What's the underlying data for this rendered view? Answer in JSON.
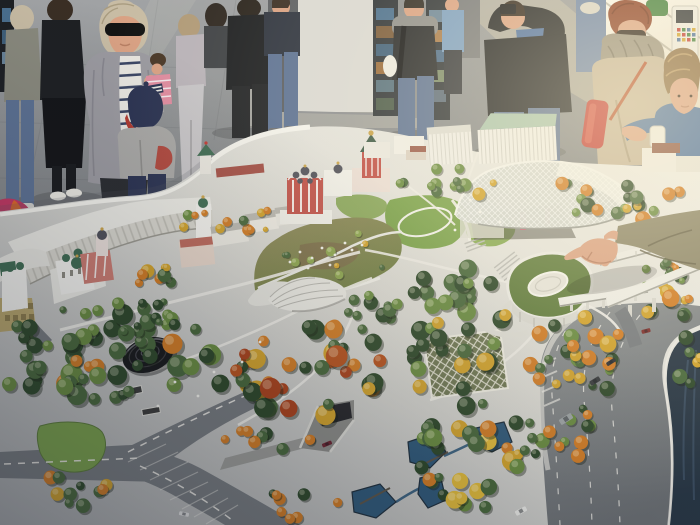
{
  "scene": {
    "type": "photograph",
    "description": "Visitors gathered around a large architectural scale model of a riverside park in autumn colours; a hand points at the model from the right; bright daylight from windows at top right.",
    "no_visible_text": true
  },
  "palette": {
    "floor": "#97999b",
    "floorDark": "#7b7e81",
    "sunFloor": "#cdc6b2",
    "wall": "#dad9d4",
    "wallShade": "#5c5f63",
    "panel": "#2e3338",
    "window": "#f8f5ec",
    "base": "#dcdbd5",
    "baseBright": "#f0efe9",
    "baseShade": "#a9abac",
    "rim": "#f3f2ec",
    "plaza": "#d7d6d0",
    "road": "#75797d",
    "roadDark": "#63676b",
    "lane": "#eceae4",
    "hwy": "#7d8286",
    "river": "#273543",
    "pond": "#2f5878",
    "lawn": "#79a04a",
    "meadowTan": "#93895c",
    "meadowGreen": "#6e7d42",
    "gDark": "#2d4729",
    "gMid": "#47663a",
    "gBright": "#67893f",
    "gLime": "#8ba44e",
    "oDeep": "#b5511d",
    "oBright": "#cf7a24",
    "rust": "#a8421c",
    "yGold": "#cfa02b",
    "yBright": "#deb83a",
    "churchRed": "#c05048",
    "churchPink": "#c97a70",
    "trim": "#f0efeb",
    "domeDark": "#50505a",
    "domeGreen": "#3f6b52",
    "gold": "#c9a24a",
    "roofGreen": "#a9c4ae",
    "roofGrey": "#b9b7b0",
    "tan": "#b5a36a",
    "disc": "#17181a",
    "bridge": "#ebeae4",
    "skin": "#d9a183",
    "skinShade": "#b87f63",
    "hairBlonde": "#c8bca4",
    "hairDark": "#3a2e24",
    "hairLt": "#b09a78",
    "hairRed": "#8a3d24",
    "hairBrown": "#8a6a42",
    "cardigan": "#9b9aa0",
    "navy": "#3a4563",
    "capNavy": "#2b3352",
    "capRed": "#b03a30",
    "hoodie": "#a9a8a6",
    "scarf": "#968e7d",
    "coat": "#c3b399",
    "jeans": "#5d7294",
    "denim": "#6d84a8",
    "blueJacket": "#4a6f9e",
    "blueShirt": "#7a9ec2",
    "black": "#1e2023",
    "darkPants": "#2b2d31",
    "grey": "#8b8d90",
    "olive": "#8a8a7e",
    "lilac": "#b8b2b8",
    "paleGrey": "#c6c4c7",
    "sand": "#d9cdb4",
    "sleeve": "#8a8468",
    "sleeveShade": "#615c45",
    "green": "#3f7d3c",
    "redBag": "#c23832",
    "pink": "#e08ca0",
    "white": "#eceae2"
  },
  "people": [
    {
      "id": "bystander-left-jeans",
      "desc": "partial figure at left edge: olive top, blue jeans, white shoes"
    },
    {
      "id": "woman-black-skirt",
      "desc": "dark top, long black skirt, white sneakers, facing away"
    },
    {
      "id": "woman-sunglasses",
      "desc": "blonde woman, large black sunglasses, grey cardigan over navy-striped top, holding a child's raised hand"
    },
    {
      "id": "toddler-pink",
      "desc": "small child in pink striped top behind the woman"
    },
    {
      "id": "child-navy-cap",
      "desc": "child in navy beanie with red brim and grey hoodie with red patch"
    },
    {
      "id": "girl-grey",
      "desc": "girl in grey top and light trousers walking away"
    },
    {
      "id": "man-black-jacket",
      "desc": "man in black jacket and dark trousers"
    },
    {
      "id": "man-blue-jeans",
      "desc": "man in dark top and blue jeans"
    },
    {
      "id": "man-vest-backpack",
      "desc": "man in grey hoodie, black vest, jeans, backpack strap, white bag"
    },
    {
      "id": "person-blue-shirt",
      "desc": "figure in light blue shirt"
    },
    {
      "id": "man-photographing",
      "desc": "man in black sweater with arms raised holding a phone, blue jeans"
    },
    {
      "id": "woman-scarf",
      "desc": "red-haired woman with sunglasses, voluminous taupe scarf, beige coat, red bag"
    },
    {
      "id": "boy-brown-hair",
      "desc": "boy with brown mop hair in blue jacket holding a white cup, reaching over the model"
    },
    {
      "id": "pointing-hand",
      "desc": "arm in olive sleeve entering from the right, index finger pointing at the model"
    }
  ],
  "model_features": [
    "curved-white-classical-building",
    "tan-block-building",
    "white-church-green-domes",
    "pink-bell-tower",
    "kremlin-tower-and-wall",
    "red-church-with-domes",
    "red-tent-roof-church",
    "street-building-row",
    "white-slab-building-green-roof",
    "black-spiral-pavilion",
    "glass-bark-canopy",
    "small-shell-canopy",
    "diagrid-glass-pavilion",
    "green-roof-amphitheatre",
    "floating-v-bridge",
    "viaduct-with-piers",
    "road-junction-with-grass-island",
    "road-tunnel-portal",
    "underpass-slots",
    "embankment-highway",
    "river-corner",
    "ponds-and-streams",
    "meadow-with-winding-paths",
    "lawns-with-path-loops",
    "tree-allees"
  ],
  "trees": {
    "clusters": [
      {
        "x": 150,
        "y": 360,
        "rx": 105,
        "ry": 52,
        "n": 44,
        "rmin": 5,
        "rmax": 11,
        "seed": 11,
        "colors": [
          "gMid",
          "gDark",
          "gBright",
          "gMid",
          "oBright",
          "gDark"
        ]
      },
      {
        "x": 28,
        "y": 345,
        "rx": 30,
        "ry": 55,
        "n": 12,
        "rmin": 5,
        "rmax": 10,
        "seed": 22,
        "colors": [
          "gMid",
          "gDark",
          "gBright"
        ]
      },
      {
        "x": 315,
        "y": 372,
        "rx": 80,
        "ry": 48,
        "n": 40,
        "rmin": 5,
        "rmax": 11,
        "seed": 33,
        "colors": [
          "oDeep",
          "oBright",
          "rust",
          "gMid",
          "yGold",
          "oBright",
          "gDark"
        ]
      },
      {
        "x": 452,
        "y": 330,
        "rx": 55,
        "ry": 70,
        "n": 36,
        "rmin": 5,
        "rmax": 10,
        "seed": 44,
        "colors": [
          "gDark",
          "gMid",
          "gDark",
          "gBright",
          "yGold"
        ]
      },
      {
        "x": 585,
        "y": 352,
        "rx": 62,
        "ry": 40,
        "n": 26,
        "rmin": 4,
        "rmax": 9,
        "seed": 55,
        "colors": [
          "gMid",
          "gDark",
          "gBright",
          "oBright",
          "yGold"
        ]
      },
      {
        "x": 625,
        "y": 196,
        "rx": 72,
        "ry": 26,
        "n": 20,
        "rmin": 4,
        "rmax": 8,
        "seed": 66,
        "colors": [
          "gMid",
          "gBright",
          "yGold",
          "gDark",
          "oBright"
        ]
      },
      {
        "x": 445,
        "y": 182,
        "rx": 50,
        "ry": 20,
        "n": 13,
        "rmin": 3,
        "rmax": 7,
        "seed": 77,
        "colors": [
          "gMid",
          "gBright",
          "yGold"
        ]
      },
      {
        "x": 330,
        "y": 252,
        "rx": 65,
        "ry": 26,
        "n": 10,
        "rmin": 2.5,
        "rmax": 5,
        "seed": 88,
        "colors": [
          "gMid",
          "gLime",
          "yGold"
        ]
      },
      {
        "x": 468,
        "y": 455,
        "rx": 55,
        "ry": 55,
        "n": 30,
        "rmin": 4,
        "rmax": 10,
        "seed": 99,
        "colors": [
          "gMid",
          "gDark",
          "yBright",
          "yGold",
          "gBright",
          "oBright"
        ]
      },
      {
        "x": 668,
        "y": 292,
        "rx": 28,
        "ry": 34,
        "n": 12,
        "rmin": 4,
        "rmax": 9,
        "seed": 101,
        "colors": [
          "yGold",
          "oBright",
          "gMid",
          "gDark"
        ]
      },
      {
        "x": 268,
        "y": 440,
        "rx": 48,
        "ry": 14,
        "n": 9,
        "rmin": 4,
        "rmax": 7,
        "seed": 111,
        "colors": [
          "gMid",
          "oBright",
          "gDark"
        ]
      },
      {
        "x": 60,
        "y": 490,
        "rx": 60,
        "ry": 20,
        "n": 10,
        "rmin": 4,
        "rmax": 8,
        "seed": 122,
        "colors": [
          "gMid",
          "gDark",
          "oBright",
          "yGold"
        ]
      },
      {
        "x": 235,
        "y": 222,
        "rx": 55,
        "ry": 16,
        "n": 12,
        "rmin": 2.5,
        "rmax": 6,
        "seed": 133,
        "colors": [
          "gMid",
          "yGold",
          "oBright",
          "gBright"
        ]
      },
      {
        "x": 372,
        "y": 312,
        "rx": 28,
        "ry": 22,
        "n": 11,
        "rmin": 4,
        "rmax": 8,
        "seed": 144,
        "colors": [
          "gMid",
          "gDark",
          "gBright"
        ]
      },
      {
        "x": 555,
        "y": 430,
        "rx": 42,
        "ry": 32,
        "n": 16,
        "rmin": 4,
        "rmax": 8,
        "seed": 155,
        "colors": [
          "gMid",
          "gDark",
          "oBright",
          "gBright"
        ]
      },
      {
        "x": 160,
        "y": 282,
        "rx": 22,
        "ry": 16,
        "n": 8,
        "rmin": 3.5,
        "rmax": 7,
        "seed": 166,
        "colors": [
          "oBright",
          "yGold",
          "gMid"
        ]
      },
      {
        "x": 120,
        "y": 315,
        "rx": 70,
        "ry": 18,
        "n": 14,
        "rmin": 3.5,
        "rmax": 7,
        "seed": 177,
        "colors": [
          "gMid",
          "gDark",
          "gBright"
        ]
      },
      {
        "x": 300,
        "y": 505,
        "rx": 40,
        "ry": 16,
        "n": 8,
        "rmin": 4,
        "rmax": 7,
        "seed": 188,
        "colors": [
          "gMid",
          "oBright",
          "gDark"
        ]
      },
      {
        "x": 655,
        "y": 275,
        "rx": 30,
        "ry": 16,
        "n": 9,
        "rmin": 3,
        "rmax": 6,
        "seed": 199,
        "colors": [
          "gMid",
          "gBright",
          "oBright"
        ]
      },
      {
        "x": 690,
        "y": 360,
        "rx": 16,
        "ry": 30,
        "n": 7,
        "rmin": 4,
        "rmax": 8,
        "seed": 210,
        "colors": [
          "gMid",
          "gDark",
          "yGold"
        ]
      }
    ]
  },
  "ponds": [
    {
      "points": "408,442 432,434 446,452 430,468 410,462"
    },
    {
      "points": "352,492 380,484 396,502 376,518 354,512"
    },
    {
      "points": "476,428 504,422 512,442 492,452 476,444"
    },
    {
      "points": "420,478 440,474 446,500 428,508 418,494"
    }
  ],
  "cars": [
    {
      "x": 595,
      "y": 381,
      "w": 11,
      "h": 5,
      "a": -32,
      "c": "#33363a"
    },
    {
      "x": 566,
      "y": 419,
      "w": 14,
      "h": 6,
      "a": -32,
      "c": "#9aa0a2"
    },
    {
      "x": 521,
      "y": 511,
      "w": 12,
      "h": 5,
      "a": -28,
      "c": "#e8e8e4"
    },
    {
      "x": 646,
      "y": 331,
      "w": 9,
      "h": 4,
      "a": -15,
      "c": "#7a2a28"
    },
    {
      "x": 327,
      "y": 444,
      "w": 10,
      "h": 4,
      "a": -22,
      "c": "#6a2430"
    },
    {
      "x": 184,
      "y": 514,
      "w": 10,
      "h": 4,
      "a": 12,
      "c": "#dedede"
    },
    {
      "x": 611,
      "y": 362,
      "w": 10,
      "h": 4,
      "a": -32,
      "c": "#2c2e33"
    }
  ],
  "figures": [
    [
      300,
      252
    ],
    [
      312,
      258
    ],
    [
      322,
      248
    ],
    [
      335,
      255
    ],
    [
      345,
      243
    ],
    [
      290,
      262
    ],
    [
      308,
      268
    ],
    [
      352,
      250
    ],
    [
      362,
      245
    ],
    [
      330,
      265
    ],
    [
      175,
      382
    ],
    [
      198,
      396
    ],
    [
      214,
      372
    ],
    [
      158,
      406
    ],
    [
      242,
      362
    ],
    [
      260,
      342
    ],
    [
      470,
      200
    ],
    [
      480,
      212
    ],
    [
      500,
      222
    ],
    [
      455,
      230
    ]
  ]
}
